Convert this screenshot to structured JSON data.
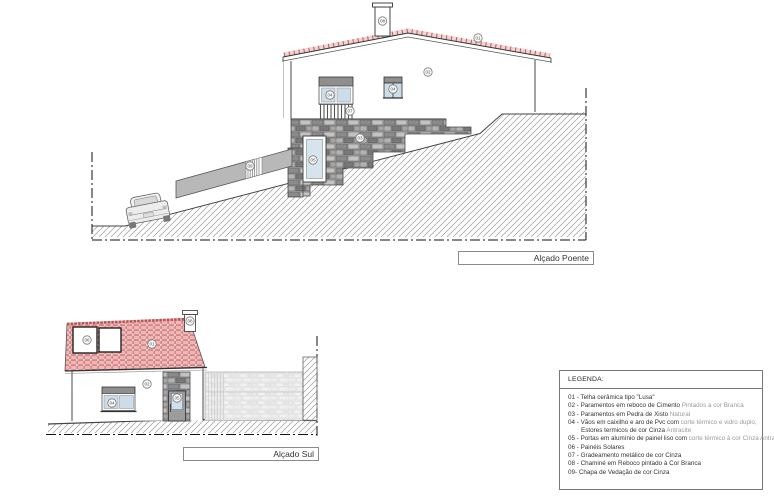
{
  "labels": {
    "poente": "Alçado Poente",
    "sul": "Alçado Sul"
  },
  "legend": {
    "title": "LEGENDA:",
    "items": [
      {
        "t1": "01 - Telha cerâmica tipo \"Lusa\"",
        "t2": ""
      },
      {
        "t1": "02 - Paramentos em reboco de Cimento ",
        "t2": "Pintados a cor Branca"
      },
      {
        "t1": "03 - Paramentos em Pedra de Xisto ",
        "t2": "Natural"
      },
      {
        "t1": "04 - Vãos em caixilho e aro de Pvc com ",
        "t2": "corte térmico e vidro duplo,"
      },
      {
        "t1": "Estores termicos de cor Cinza ",
        "t2": "Antracite"
      },
      {
        "t1": "05 - Portas em alumínio de painel liso com ",
        "t2": "corte térmico à cor Cinza Antracite"
      },
      {
        "t1": "06 - Painéis Solares",
        "t2": ""
      },
      {
        "t1": "07 - Gradeamento metálico de cor Cinza",
        "t2": ""
      },
      {
        "t1": "08 - Chaminé em Reboco pintado à Cor Branca",
        "t2": ""
      },
      {
        "t1": "09- Chapa de Vedação de cor Cinza",
        "t2": ""
      }
    ]
  },
  "callouts": {
    "poente": {
      "chimney": "08",
      "roof": "01",
      "wall": "02",
      "window_large": "04",
      "railing": "07",
      "window_small": "04",
      "stone_wall": "03",
      "door": "05",
      "fence": "09"
    },
    "sul": {
      "solar_panel": "06",
      "roof": "01",
      "chimney": "08",
      "wall": "02",
      "window": "04",
      "door": "05"
    }
  },
  "colors": {
    "tile_red": "#c45c5c",
    "tile_pink": "#f1b6b6",
    "stone_gray": "#9e9e9e",
    "stone_light": "#efefef",
    "fence_gray": "#b8b8b8",
    "glass_blue": "#ccdce8",
    "shutterbox_gray": "#8f8f8f",
    "line_dark": "#333333",
    "hatch_gray": "#9a9a9a"
  }
}
